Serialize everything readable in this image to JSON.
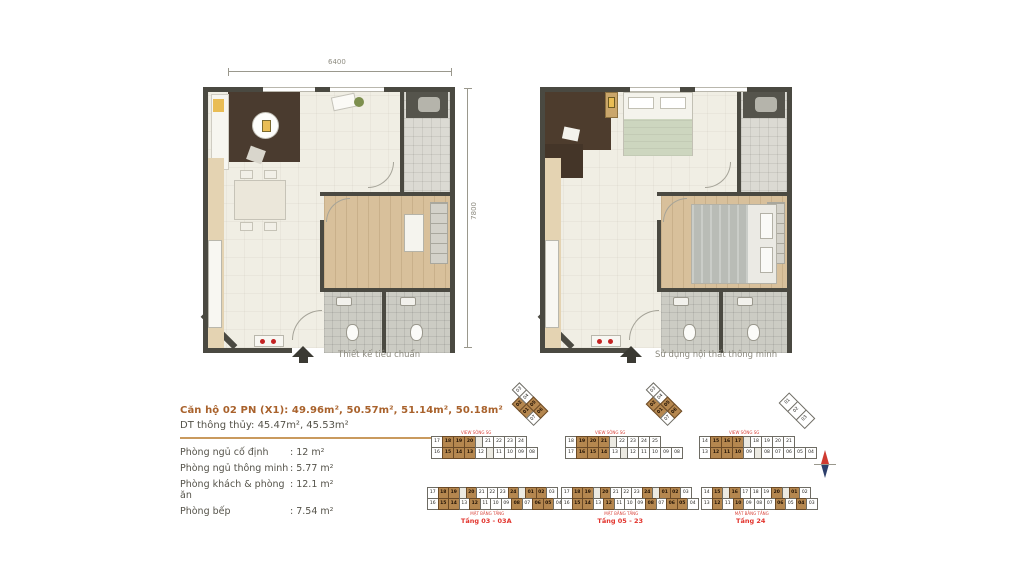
{
  "dimensions": {
    "width_label": "6400",
    "height_label": "7800"
  },
  "plans": [
    {
      "caption": "Thiết kế tiêu chuẩn"
    },
    {
      "caption": "Sử dụng nội thất thông minh"
    }
  ],
  "info": {
    "title": "Căn hộ 02 PN (X1): 49.96m², 50.57m², 51.14m², 50.18m²",
    "subtitle": "DT thông thủy: 45.47m², 45.53m²",
    "rows": [
      {
        "label": "Phòng ngủ cố định",
        "value": ": 12 m²"
      },
      {
        "label": "Phòng ngủ thông minh",
        "value": ": 5.77 m²"
      },
      {
        "label": "Phòng khách & phòng ăn",
        "value": ": 12.1 m²"
      },
      {
        "label": "Phòng bếp",
        "value": ": 7.54 m²"
      }
    ]
  },
  "keyplans": {
    "highlight_color": "#b5874f",
    "label_color": "#e2332c",
    "diagrams": [
      {
        "x": 432,
        "y": 437,
        "size": "normal",
        "micro": "VIEW SÔNG SG",
        "micro_pos": "top",
        "wing": "A",
        "top": [
          {
            "n": "17"
          },
          {
            "n": "18",
            "hl": 1
          },
          {
            "n": "19",
            "hl": 1
          },
          {
            "n": "20",
            "hl": 1
          },
          {
            "core": 1
          },
          {
            "n": "21"
          },
          {
            "n": "22"
          },
          {
            "n": "23"
          },
          {
            "n": "24"
          }
        ],
        "bottom": [
          {
            "n": "16"
          },
          {
            "n": "15",
            "hl": 1
          },
          {
            "n": "14",
            "hl": 1
          },
          {
            "n": "13",
            "hl": 1
          },
          {
            "n": "12"
          },
          {
            "core": 1
          },
          {
            "n": "11"
          },
          {
            "n": "10"
          },
          {
            "n": "09"
          },
          {
            "n": "08"
          }
        ]
      },
      {
        "x": 566,
        "y": 437,
        "size": "normal",
        "micro": "VIEW SÔNG SG",
        "micro_pos": "top",
        "wing": "A",
        "top": [
          {
            "n": "18"
          },
          {
            "n": "19",
            "hl": 1
          },
          {
            "n": "20",
            "hl": 1
          },
          {
            "n": "21",
            "hl": 1
          },
          {
            "core": 1
          },
          {
            "n": "22"
          },
          {
            "n": "23"
          },
          {
            "n": "24"
          },
          {
            "n": "25"
          }
        ],
        "bottom": [
          {
            "n": "17"
          },
          {
            "n": "16",
            "hl": 1
          },
          {
            "n": "15",
            "hl": 1
          },
          {
            "n": "14",
            "hl": 1
          },
          {
            "n": "13"
          },
          {
            "core": 1
          },
          {
            "n": "12"
          },
          {
            "n": "11"
          },
          {
            "n": "10"
          },
          {
            "n": "09"
          },
          {
            "n": "08"
          }
        ]
      },
      {
        "x": 700,
        "y": 437,
        "size": "normal",
        "micro": "VIEW SÔNG SG",
        "micro_pos": "top",
        "wing": "B",
        "top": [
          {
            "n": "14"
          },
          {
            "n": "15",
            "hl": 1
          },
          {
            "n": "16",
            "hl": 1
          },
          {
            "n": "17",
            "hl": 1
          },
          {
            "core": 1
          },
          {
            "n": "18"
          },
          {
            "n": "19"
          },
          {
            "n": "20"
          },
          {
            "n": "21"
          }
        ],
        "bottom": [
          {
            "n": "13"
          },
          {
            "n": "12",
            "hl": 1
          },
          {
            "n": "11",
            "hl": 1
          },
          {
            "n": "10",
            "hl": 1
          },
          {
            "n": "09"
          },
          {
            "core": 1
          },
          {
            "n": "08"
          },
          {
            "n": "07"
          },
          {
            "n": "06"
          },
          {
            "n": "05"
          },
          {
            "n": "04"
          }
        ]
      },
      {
        "x": 428,
        "y": 488,
        "size": "small",
        "micro": "MẶT BẰNG TẦNG",
        "micro_pos": "bottom",
        "label": "Tầng 03 - 03A",
        "top": [
          {
            "n": "17"
          },
          {
            "n": "18",
            "hl": 1
          },
          {
            "n": "19",
            "hl": 1
          },
          {
            "core": 1
          },
          {
            "n": "20",
            "hl": 1
          },
          {
            "n": "21"
          },
          {
            "n": "22"
          },
          {
            "n": "23"
          },
          {
            "n": "24",
            "hl": 1
          },
          {
            "core": 1
          },
          {
            "n": "01",
            "hl": 1
          },
          {
            "n": "02",
            "hl": 1
          },
          {
            "n": "03"
          }
        ],
        "bottom": [
          {
            "n": "16"
          },
          {
            "n": "15",
            "hl": 1
          },
          {
            "n": "14",
            "hl": 1
          },
          {
            "n": "13"
          },
          {
            "n": "12",
            "hl": 1
          },
          {
            "n": "11"
          },
          {
            "n": "10"
          },
          {
            "n": "09"
          },
          {
            "n": "08",
            "hl": 1
          },
          {
            "n": "07"
          },
          {
            "n": "06",
            "hl": 1
          },
          {
            "n": "05",
            "hl": 1
          },
          {
            "n": "04"
          }
        ]
      },
      {
        "x": 562,
        "y": 488,
        "size": "small",
        "micro": "MẶT BẰNG TẦNG",
        "micro_pos": "bottom",
        "label": "Tầng 05 - 23",
        "top": [
          {
            "n": "17"
          },
          {
            "n": "18",
            "hl": 1
          },
          {
            "n": "19",
            "hl": 1
          },
          {
            "core": 1
          },
          {
            "n": "20",
            "hl": 1
          },
          {
            "n": "21"
          },
          {
            "n": "22"
          },
          {
            "n": "23"
          },
          {
            "n": "24",
            "hl": 1
          },
          {
            "core": 1
          },
          {
            "n": "01",
            "hl": 1
          },
          {
            "n": "02",
            "hl": 1
          },
          {
            "n": "03"
          }
        ],
        "bottom": [
          {
            "n": "16"
          },
          {
            "n": "15",
            "hl": 1
          },
          {
            "n": "14",
            "hl": 1
          },
          {
            "n": "13"
          },
          {
            "n": "12",
            "hl": 1
          },
          {
            "n": "11"
          },
          {
            "n": "10"
          },
          {
            "n": "09"
          },
          {
            "n": "08",
            "hl": 1
          },
          {
            "n": "07"
          },
          {
            "n": "06",
            "hl": 1
          },
          {
            "n": "05",
            "hl": 1
          },
          {
            "n": "04"
          }
        ]
      },
      {
        "x": 702,
        "y": 488,
        "size": "small",
        "micro": "MẶT BẰNG TẦNG",
        "micro_pos": "bottom",
        "label": "Tầng 24",
        "top": [
          {
            "n": "14"
          },
          {
            "n": "15",
            "hl": 1
          },
          {
            "core": 1
          },
          {
            "n": "16",
            "hl": 1
          },
          {
            "n": "17"
          },
          {
            "n": "18"
          },
          {
            "n": "19"
          },
          {
            "n": "20",
            "hl": 1
          },
          {
            "core": 1
          },
          {
            "n": "01",
            "hl": 1
          },
          {
            "n": "02"
          }
        ],
        "bottom": [
          {
            "n": "13"
          },
          {
            "n": "12",
            "hl": 1
          },
          {
            "n": "11"
          },
          {
            "n": "10",
            "hl": 1
          },
          {
            "n": "09"
          },
          {
            "n": "08"
          },
          {
            "n": "07"
          },
          {
            "n": "06",
            "hl": 1
          },
          {
            "n": "05"
          },
          {
            "n": "04",
            "hl": 1
          },
          {
            "n": "03"
          }
        ]
      }
    ],
    "wingA": [
      [
        {
          "blank": 1
        },
        {
          "n": "03"
        }
      ],
      [
        {
          "n": "02",
          "hl": 1
        },
        {
          "n": "04"
        }
      ],
      [
        {
          "n": "01",
          "hl": 1
        },
        {
          "n": "05",
          "hl": 1
        }
      ],
      [
        {
          "n": "07"
        },
        {
          "n": "06",
          "hl": 1
        }
      ]
    ],
    "wingB": [
      [
        {
          "n": "01"
        }
      ],
      [
        {
          "n": "02"
        }
      ],
      [
        {
          "n": "03"
        }
      ]
    ]
  }
}
